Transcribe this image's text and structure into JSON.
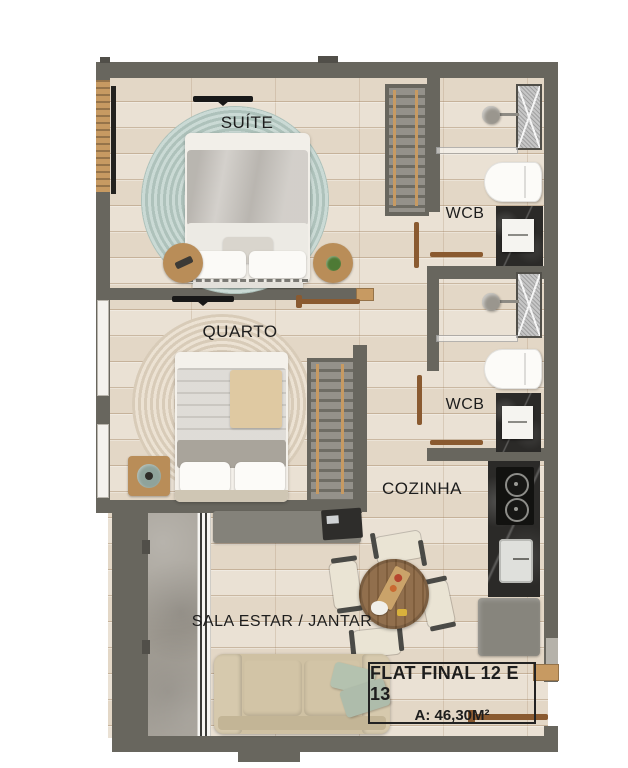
{
  "plan": {
    "rooms": [
      {
        "id": "suite",
        "label": "SUÍTE"
      },
      {
        "id": "quarto",
        "label": "QUARTO"
      },
      {
        "id": "wcb-suite",
        "label": "WCB"
      },
      {
        "id": "wcb-social",
        "label": "WCB"
      },
      {
        "id": "cozinha",
        "label": "COZINHA"
      },
      {
        "id": "sala-estar-jantar",
        "label": "SALA ESTAR / JANTAR"
      }
    ],
    "info_box": {
      "title": "FLAT FINAL 12 E 13",
      "area": "A: 46,30M²"
    }
  },
  "colors": {
    "wall": "#68665e",
    "wall_dark": "#514f49",
    "floor": "#e8decf",
    "concrete": "#a39e95",
    "rug_suite": "#b9cec7",
    "rug_quarto": "#e5d8c4",
    "marble": "#2b2a28",
    "wood": "#b98d58",
    "window_wood": "#c79a62",
    "door": "#8a5a30",
    "sofa": "#cfc1a3",
    "pillow": "#b4c2af",
    "console": "#84827a",
    "table_wood": "#8a6642",
    "text": "#1d1d1d",
    "background": "#ffffff"
  }
}
